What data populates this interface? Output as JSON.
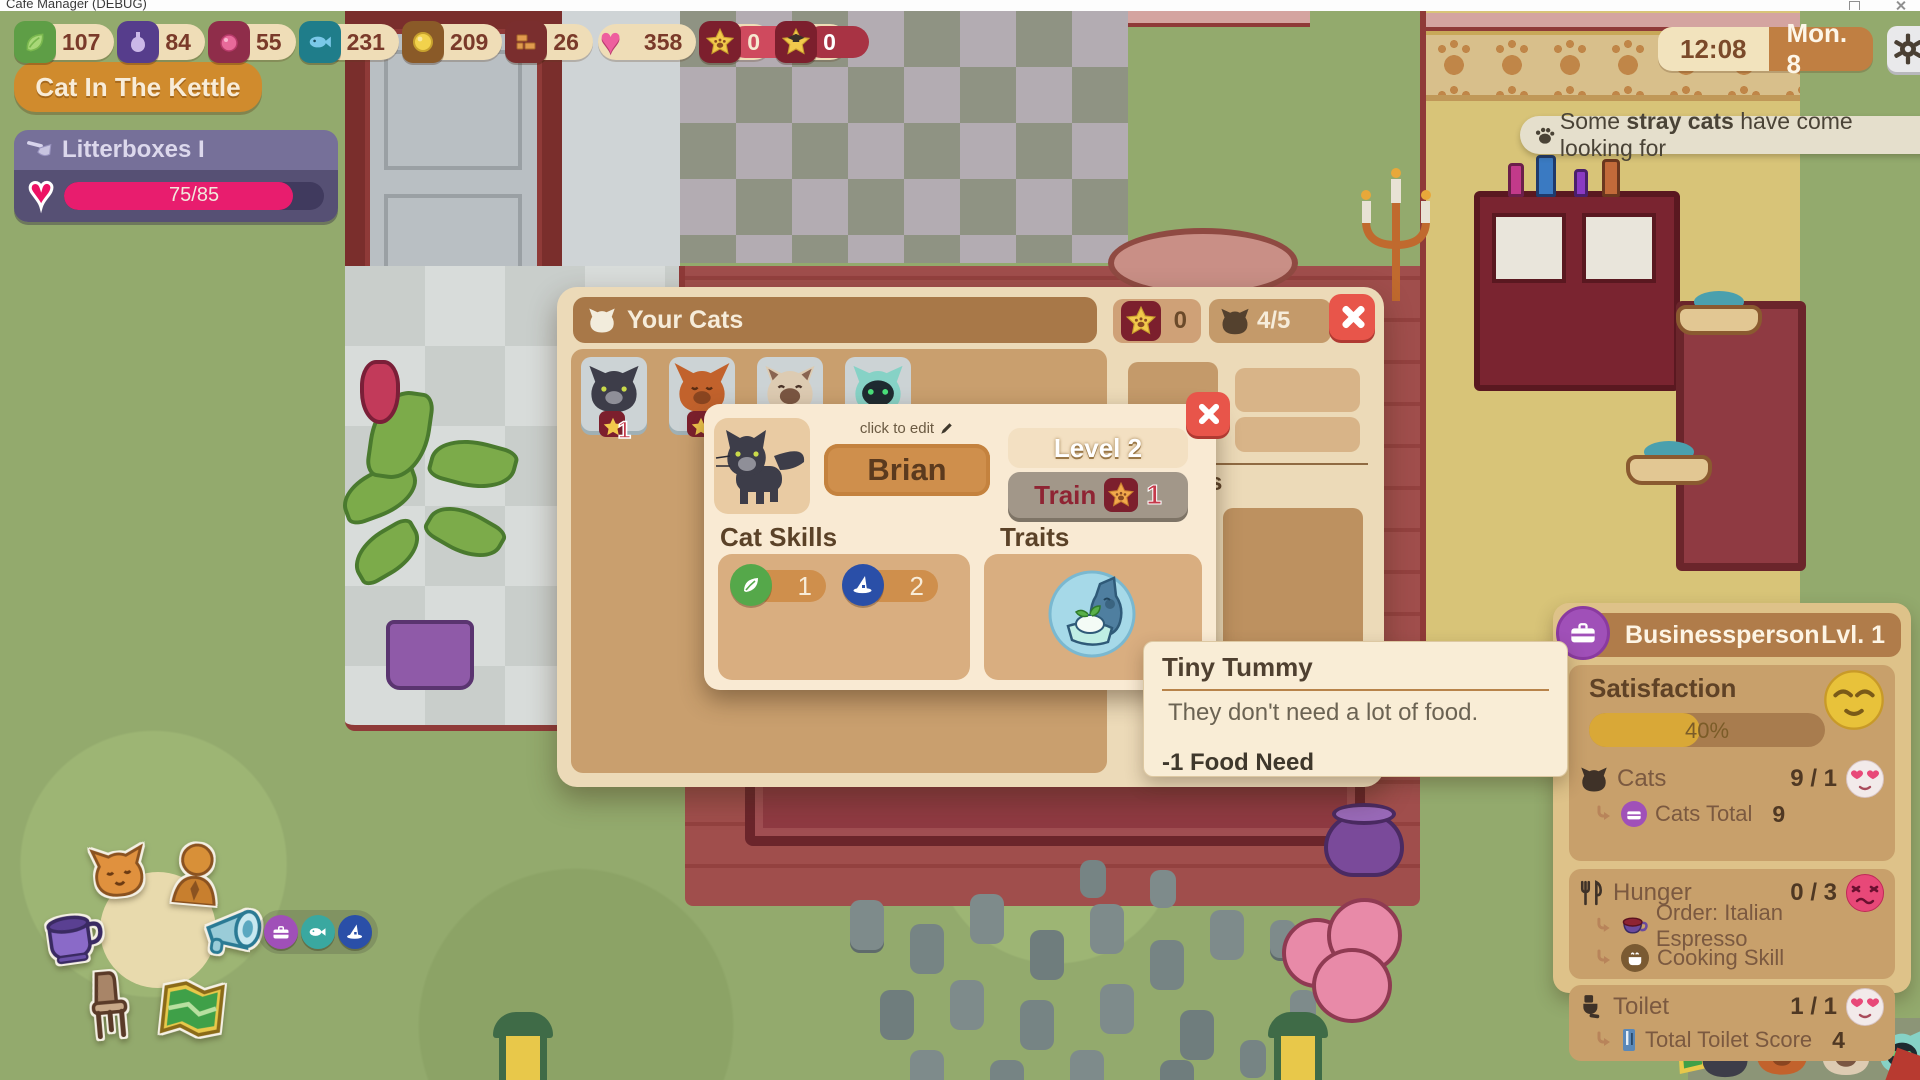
{
  "window": {
    "title": "Cafe Manager (DEBUG)"
  },
  "colors": {
    "accent_orange": "#d08b2d",
    "hud_pill": "#efddb7",
    "hud_text": "#7a3a2a",
    "pink_heart": "#ee5f9e",
    "litter_fill": "#e81d6e",
    "dialog_bg": "#ecdab8",
    "dialog_header": "#a87848",
    "popup_bg": "#f9ead3",
    "close_red": "#e8554a",
    "train_grey": "#a29789",
    "train_text": "#8f2433",
    "customer_bg": "#dec289",
    "satisfaction_fill": "#d9a837",
    "job_purple": "#a050b8"
  },
  "hud": {
    "resources": [
      {
        "icon": "greens-icon",
        "value": "107"
      },
      {
        "icon": "potion-bottle-icon",
        "value": "84"
      },
      {
        "icon": "berry-icon",
        "value": "55"
      },
      {
        "icon": "fish-icon",
        "value": "231"
      },
      {
        "icon": "coin-icon",
        "value": "209"
      },
      {
        "icon": "bricks-icon",
        "value": "26"
      },
      {
        "icon": "heart-icon",
        "value": "358"
      },
      {
        "icon": "star-paw-icon",
        "value": "0"
      },
      {
        "icon": "star-graduate-icon",
        "value": "0"
      }
    ]
  },
  "clock": {
    "time": "12:08",
    "date": "Mon. 8"
  },
  "kettle_button": {
    "label": "Cat In The Kettle"
  },
  "litterboxes": {
    "title": "Litterboxes I",
    "progress": "75/85",
    "pct": 88
  },
  "notification": {
    "pre": "Some ",
    "bold": "stray cats",
    "post": " have come looking for"
  },
  "your_cats": {
    "title": "Your Cats",
    "star_count": "0",
    "cat_slots": "4/5",
    "thumbnails": [
      {
        "cat": "black-cat",
        "badge": "1"
      },
      {
        "cat": "orange-cat",
        "badge": ""
      },
      {
        "cat": "siamese-cat",
        "badge": ""
      },
      {
        "cat": "robot-cat",
        "badge": ""
      }
    ],
    "side_heading_fragment": "s"
  },
  "cat_detail": {
    "edit_hint": "click to edit",
    "name": "Brian",
    "level": "Level 2",
    "train_label": "Train",
    "train_cost": "1",
    "skills_title": "Cat Skills",
    "skills": [
      {
        "icon": "leaf-skill-icon",
        "value": "1"
      },
      {
        "icon": "witch-hat-skill-icon",
        "value": "2"
      }
    ],
    "traits_title": "Traits",
    "trait_icon": "tiny-tummy-trait-icon"
  },
  "tooltip": {
    "title": "Tiny Tummy",
    "description": "They don't need a lot of food.",
    "effect": "-1 Food Need"
  },
  "customer": {
    "title": "Businessperson",
    "level": "Lvl. 1",
    "satisfaction": {
      "label": "Satisfaction",
      "value": "40%",
      "pct": 47,
      "emoji": "relieved-face"
    },
    "groups": [
      {
        "icon": "cat-icon",
        "label": "Cats",
        "value": "9 / 1",
        "emoji": "heart-eyes-face",
        "subs": [
          {
            "icon": "briefcase-icon",
            "label": "Cats Total",
            "value": "9"
          }
        ]
      },
      {
        "icon": "cutlery-icon",
        "label": "Hunger",
        "value": "0 / 3",
        "emoji": "distressed-face",
        "subs": [
          {
            "icon": "espresso-cup-icon",
            "label": "Order: Italian Espresso",
            "value": ""
          },
          {
            "icon": "cooking-pot-icon",
            "label": "Cooking Skill",
            "value": ""
          }
        ]
      },
      {
        "icon": "toilet-icon",
        "label": "Toilet",
        "value": "1 / 1",
        "emoji": "heart-eyes-face",
        "subs": [
          {
            "icon": "toilet-score-icon",
            "label": "Total Toilet Score",
            "value": "4"
          }
        ]
      }
    ]
  },
  "radial_menu": {
    "items": [
      {
        "icon": "cat-face-icon"
      },
      {
        "icon": "person-icon"
      },
      {
        "icon": "coffee-cup-icon"
      },
      {
        "icon": "megaphone-icon"
      },
      {
        "icon": "chair-icon"
      },
      {
        "icon": "map-icon"
      }
    ],
    "quick": [
      {
        "icon": "briefcase-icon"
      },
      {
        "icon": "fish-icon"
      },
      {
        "icon": "witch-hat-icon"
      }
    ]
  }
}
